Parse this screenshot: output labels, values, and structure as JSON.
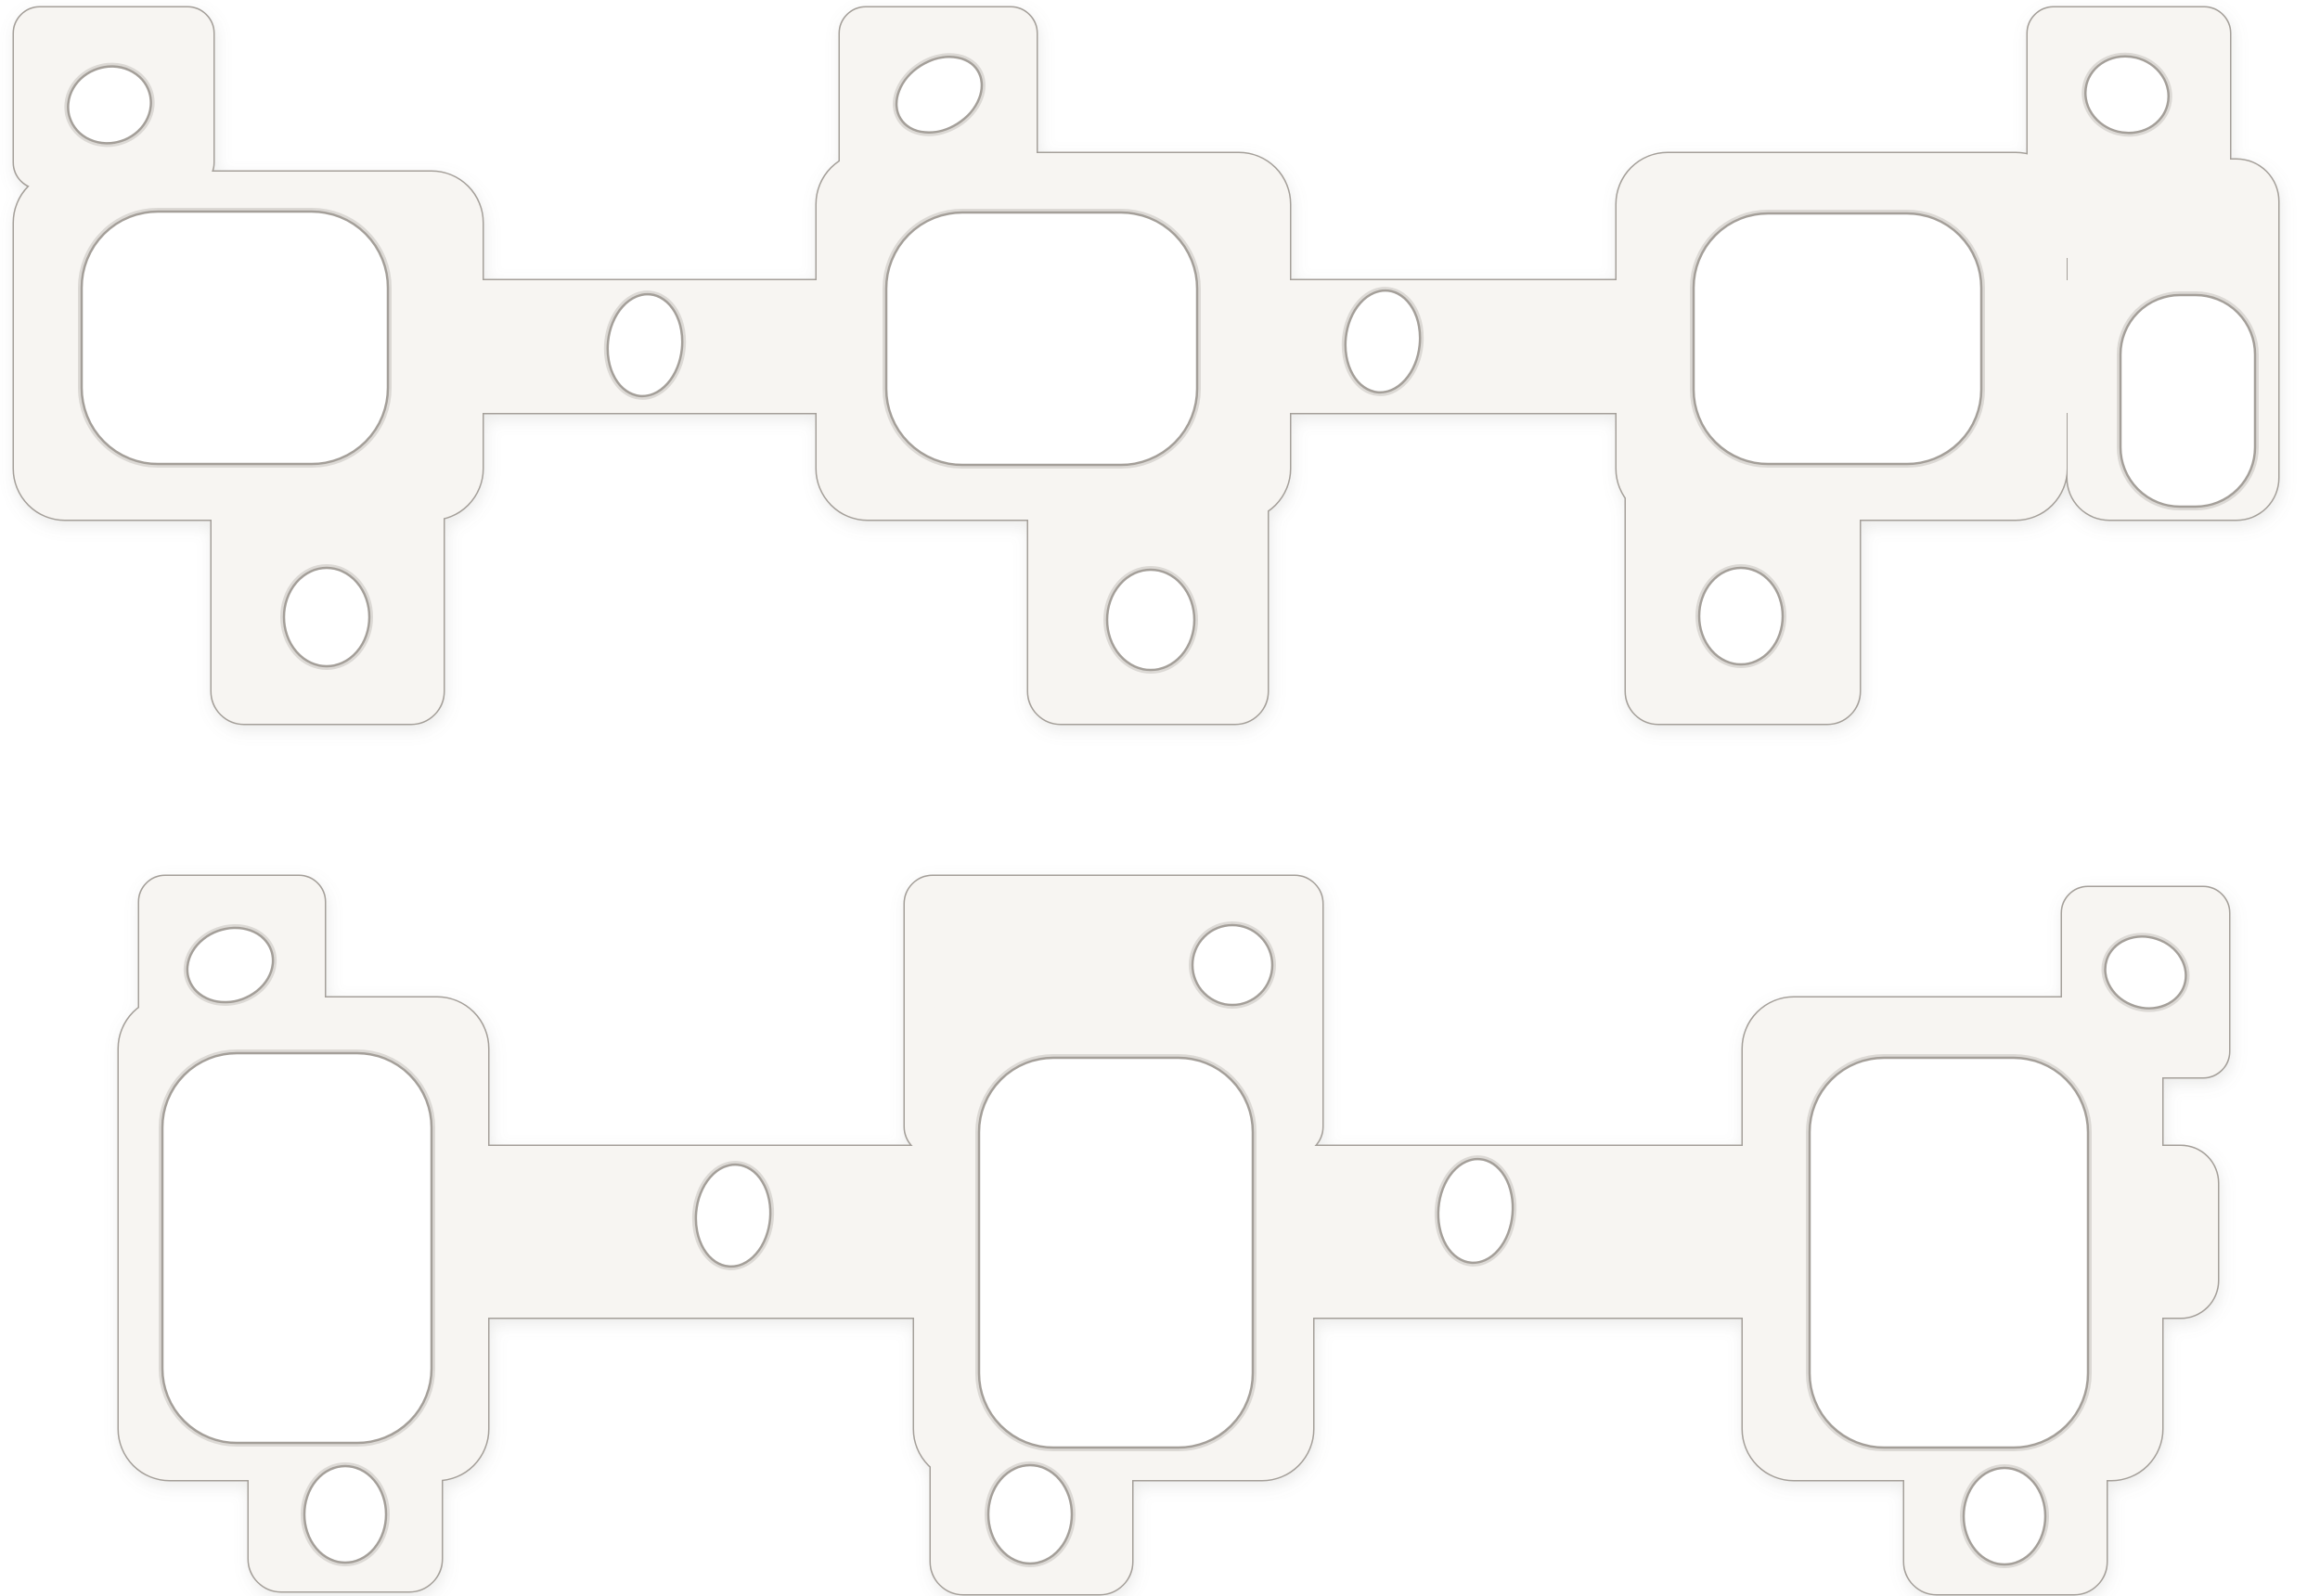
{
  "meta": {
    "kind": "product-photo",
    "description": "Two perforated exhaust manifold gaskets photographed on a plain white background, stacked vertically",
    "visible_text": ""
  },
  "scene": {
    "background": "white seamless",
    "gaskets": [
      {
        "id": "gasket-top",
        "position": "upper",
        "exhaust_ports": 3,
        "end_oval_port": 1,
        "bolt_holes_top_tabs": 3,
        "bolt_holes_bottom_legs": 3,
        "small_runner_holes": 2,
        "finish": "matte white composite facing, perforated with tan dots"
      },
      {
        "id": "gasket-bottom",
        "position": "lower",
        "exhaust_ports": 3,
        "end_oval_port": 0,
        "bolt_holes_top_tabs": 3,
        "bolt_holes_bottom_legs": 3,
        "small_runner_holes": 2,
        "finish": "matte white composite facing with bright brushed-steel core exposed across the middle section, denser perforation there"
      }
    ]
  },
  "colors": {
    "background": "#ffffff",
    "gasket_base": "#f7f5f2",
    "gasket_edge": "#a49f99",
    "dot_fill": "#ccb399",
    "dot_edge": "#a98f72",
    "dense_dot_fill": "#c3aa8f",
    "steel_light": "#eeedeb",
    "steel_dark": "#c8c5c1",
    "hole_rim": "#dcd9d5",
    "shadow": "#8a8782"
  }
}
